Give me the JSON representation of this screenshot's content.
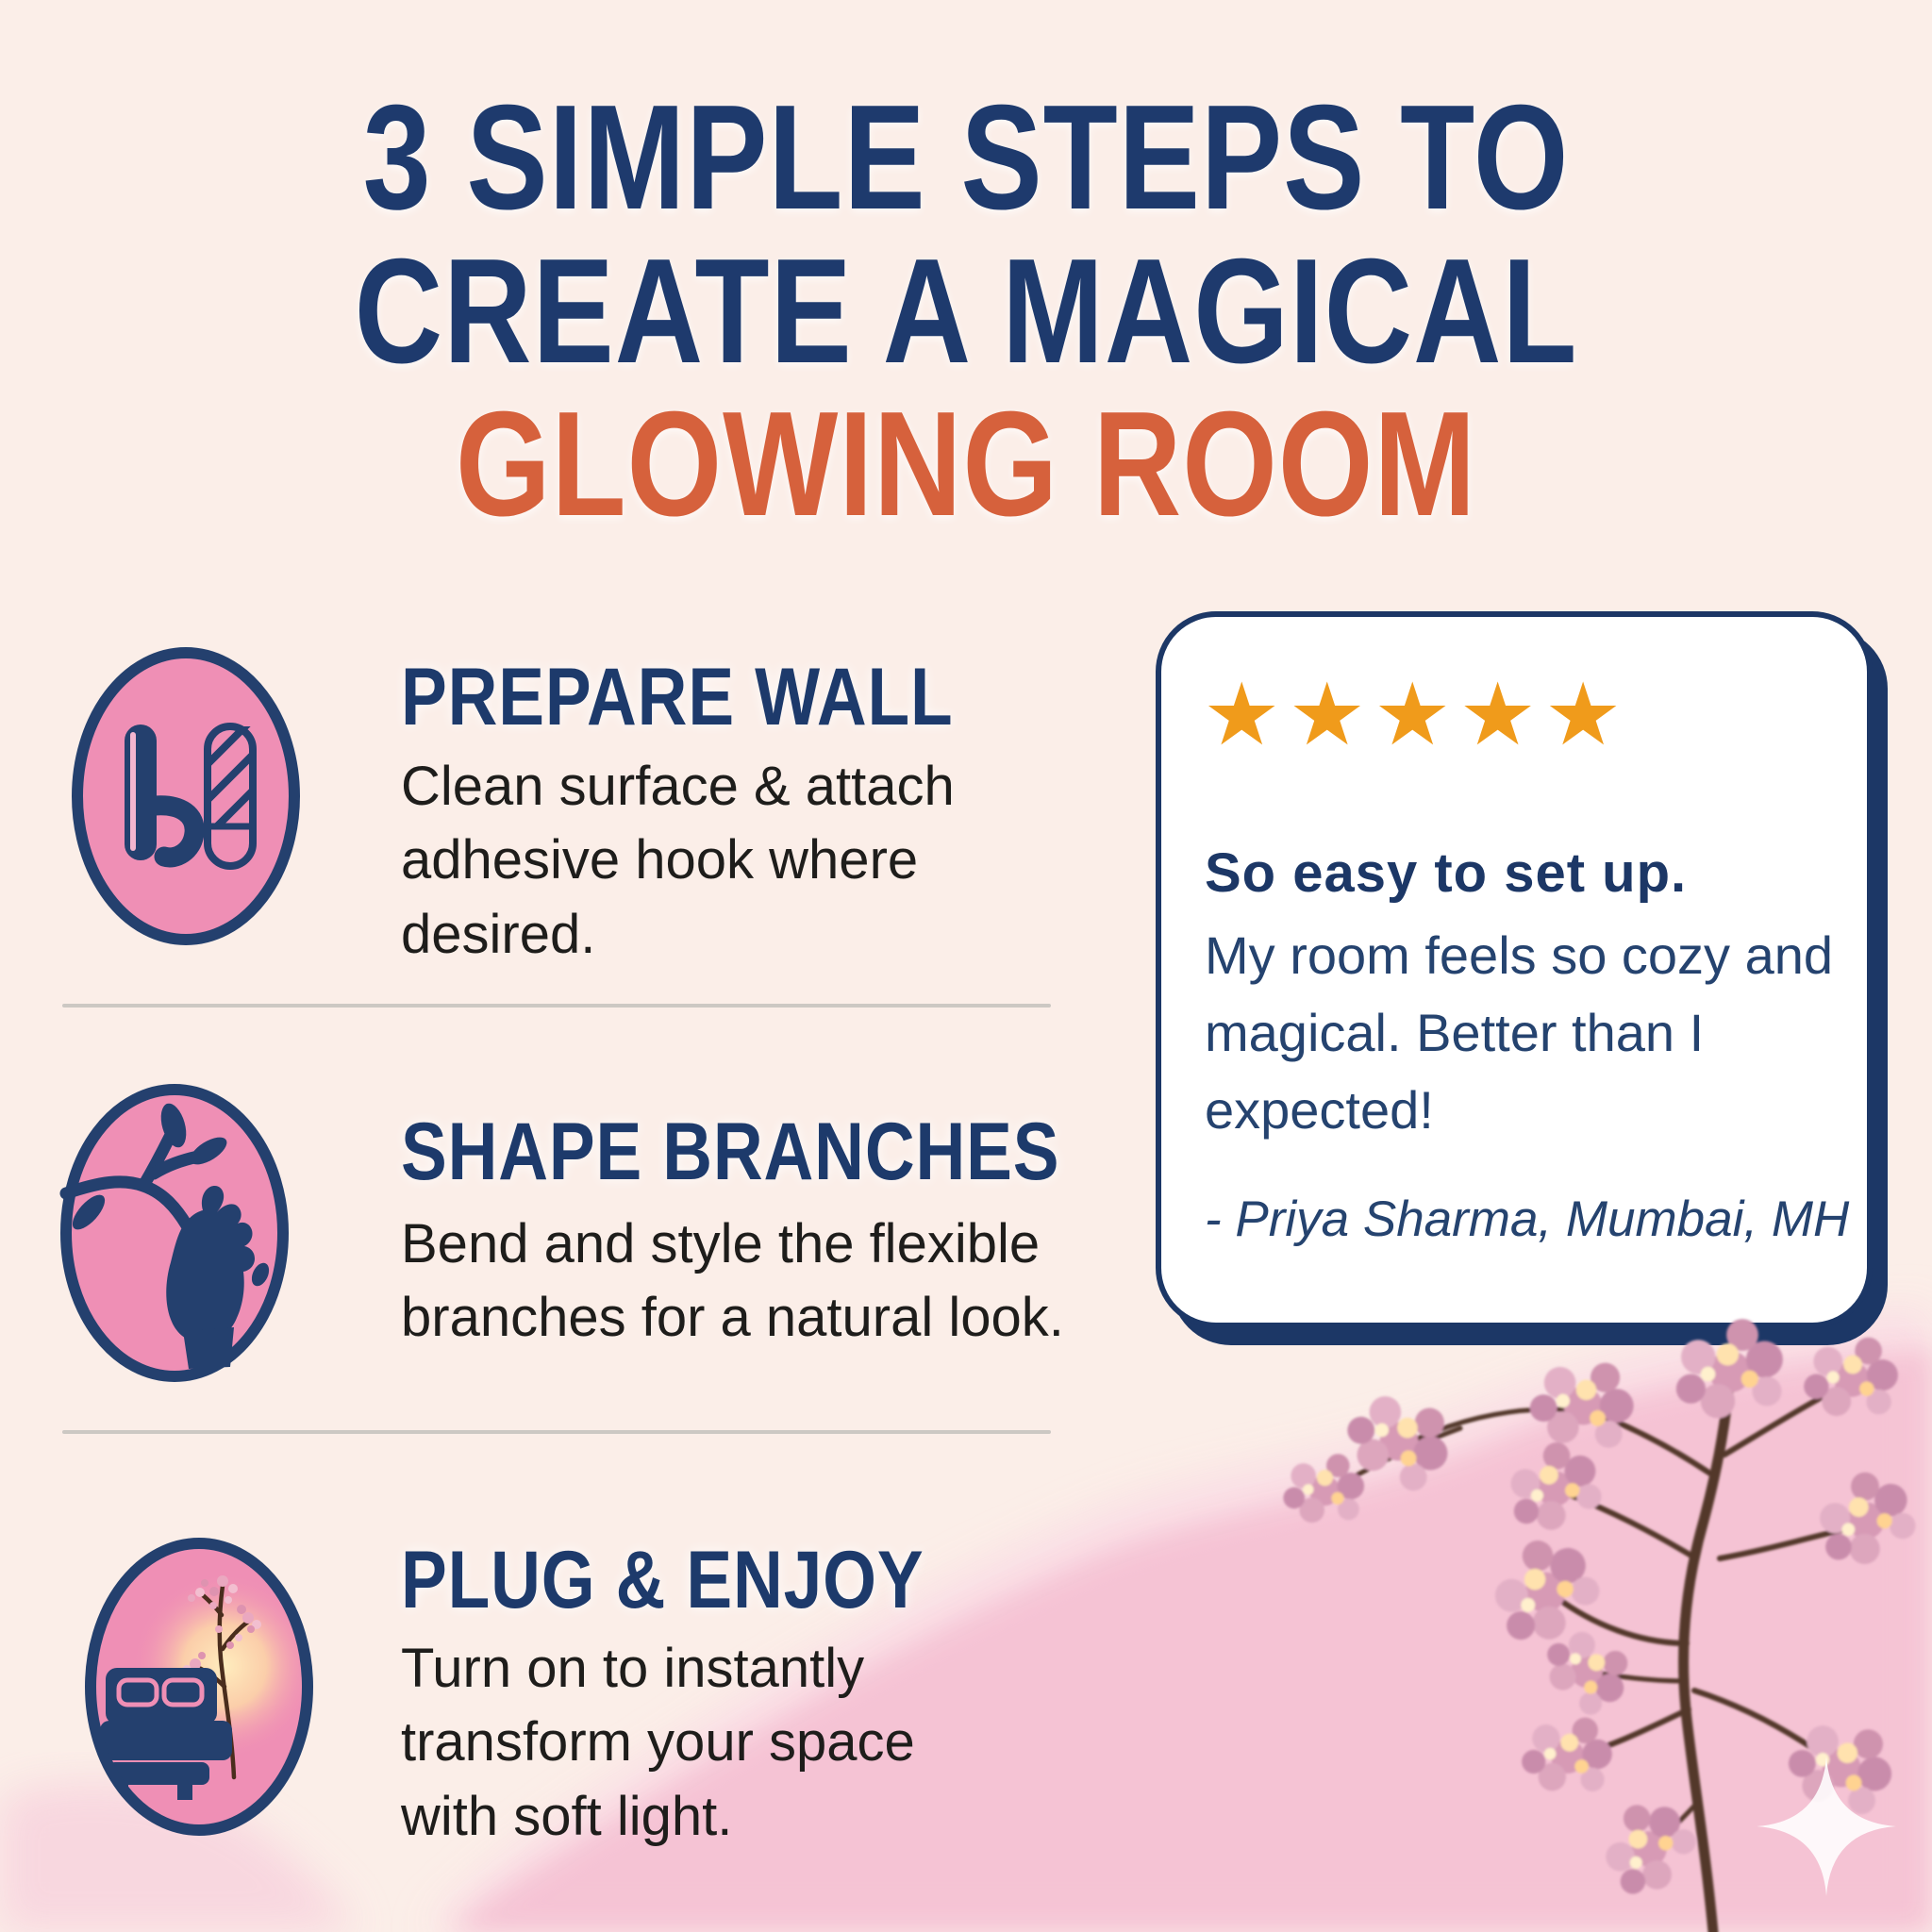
{
  "title": {
    "line1": "3 SIMPLE STEPS TO",
    "line2": "CREATE A MAGICAL",
    "line3": "GLOWING ROOM"
  },
  "steps": [
    {
      "icon": "adhesive-hook-and-strip-icon",
      "heading": "PREPARE WALL",
      "body": "Clean surface & attach adhesive hook where desired."
    },
    {
      "icon": "hand-bending-branch-icon",
      "heading": "SHAPE BRANCHES",
      "body": "Bend and style the flexible branches for a natural look."
    },
    {
      "icon": "bed-with-glowing-tree-icon",
      "heading": "PLUG & ENJOY",
      "body": "Turn on to instantly transform your space with soft light."
    }
  ],
  "review": {
    "rating": 5,
    "stars": "★★★★★",
    "headline": "So easy to set up.",
    "body": "My room feels so cozy and magical. Better than I expected!",
    "attribution": "- Priya Sharma, Mumbai, MH"
  },
  "decor": {
    "branch": "lighted-cherry-blossom-branch",
    "sparkle": "sparkle"
  },
  "colors": {
    "navy": "#1e3a6d",
    "orange": "#d6613c",
    "star_orange": "#f09b1b",
    "circle_pink": "#ef8fb5",
    "background_cream": "#fbeee8",
    "wash_pink": "#f5c3d4",
    "card_white": "#ffffff",
    "body_text": "#1e1d1b",
    "divider_gray": "#ccc8c3"
  }
}
